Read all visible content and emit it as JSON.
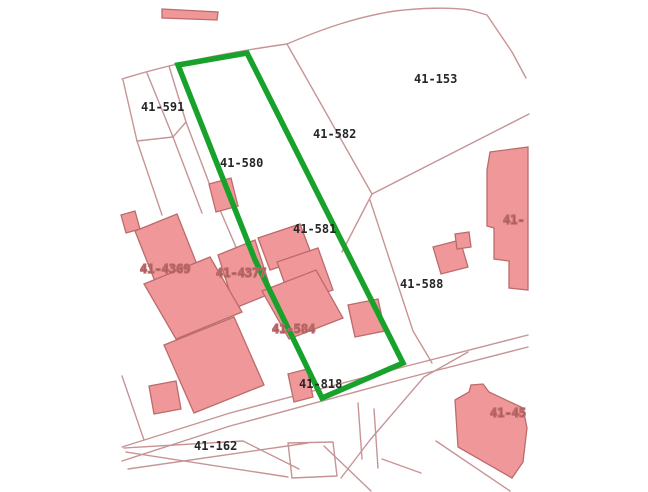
{
  "map": {
    "description_labels_visible": true,
    "colors": {
      "background": "#ffffff",
      "parcel_line": "#c79495",
      "building_fill": "#f09899",
      "building_stroke": "#bb6b6b",
      "highlight_outline": "#18a22c",
      "parcel_label_text": "#262626",
      "building_label_text": "#a04040"
    },
    "highlight": {
      "contains_label": "41-580"
    },
    "labels": [
      {
        "id": "41-591",
        "text": "41-591",
        "x": 141,
        "y": 111,
        "kind": "parcel"
      },
      {
        "id": "41-580",
        "text": "41-580",
        "x": 220,
        "y": 167,
        "kind": "parcel"
      },
      {
        "id": "41-582",
        "text": "41-582",
        "x": 313,
        "y": 138,
        "kind": "parcel"
      },
      {
        "id": "41-153",
        "text": "41-153",
        "x": 414,
        "y": 83,
        "kind": "parcel"
      },
      {
        "id": "41-581",
        "text": "41-581",
        "x": 293,
        "y": 233,
        "kind": "parcel"
      },
      {
        "id": "41-588",
        "text": "41-588",
        "x": 400,
        "y": 288,
        "kind": "parcel"
      },
      {
        "id": "41-818",
        "text": "41-818",
        "x": 299,
        "y": 388,
        "kind": "parcel"
      },
      {
        "id": "41-162",
        "text": "41-162",
        "x": 194,
        "y": 450,
        "kind": "parcel"
      },
      {
        "id": "41-4369",
        "text": "41-4369",
        "x": 140,
        "y": 273,
        "kind": "building"
      },
      {
        "id": "41-4377",
        "text": "41-4377",
        "x": 216,
        "y": 277,
        "kind": "building"
      },
      {
        "id": "41-584",
        "text": "41-584",
        "x": 272,
        "y": 333,
        "kind": "building"
      },
      {
        "id": "41-edge",
        "text": "41-",
        "x": 503,
        "y": 224,
        "kind": "building"
      },
      {
        "id": "41-45",
        "text": "41-45",
        "x": 490,
        "y": 417,
        "kind": "building"
      }
    ]
  }
}
